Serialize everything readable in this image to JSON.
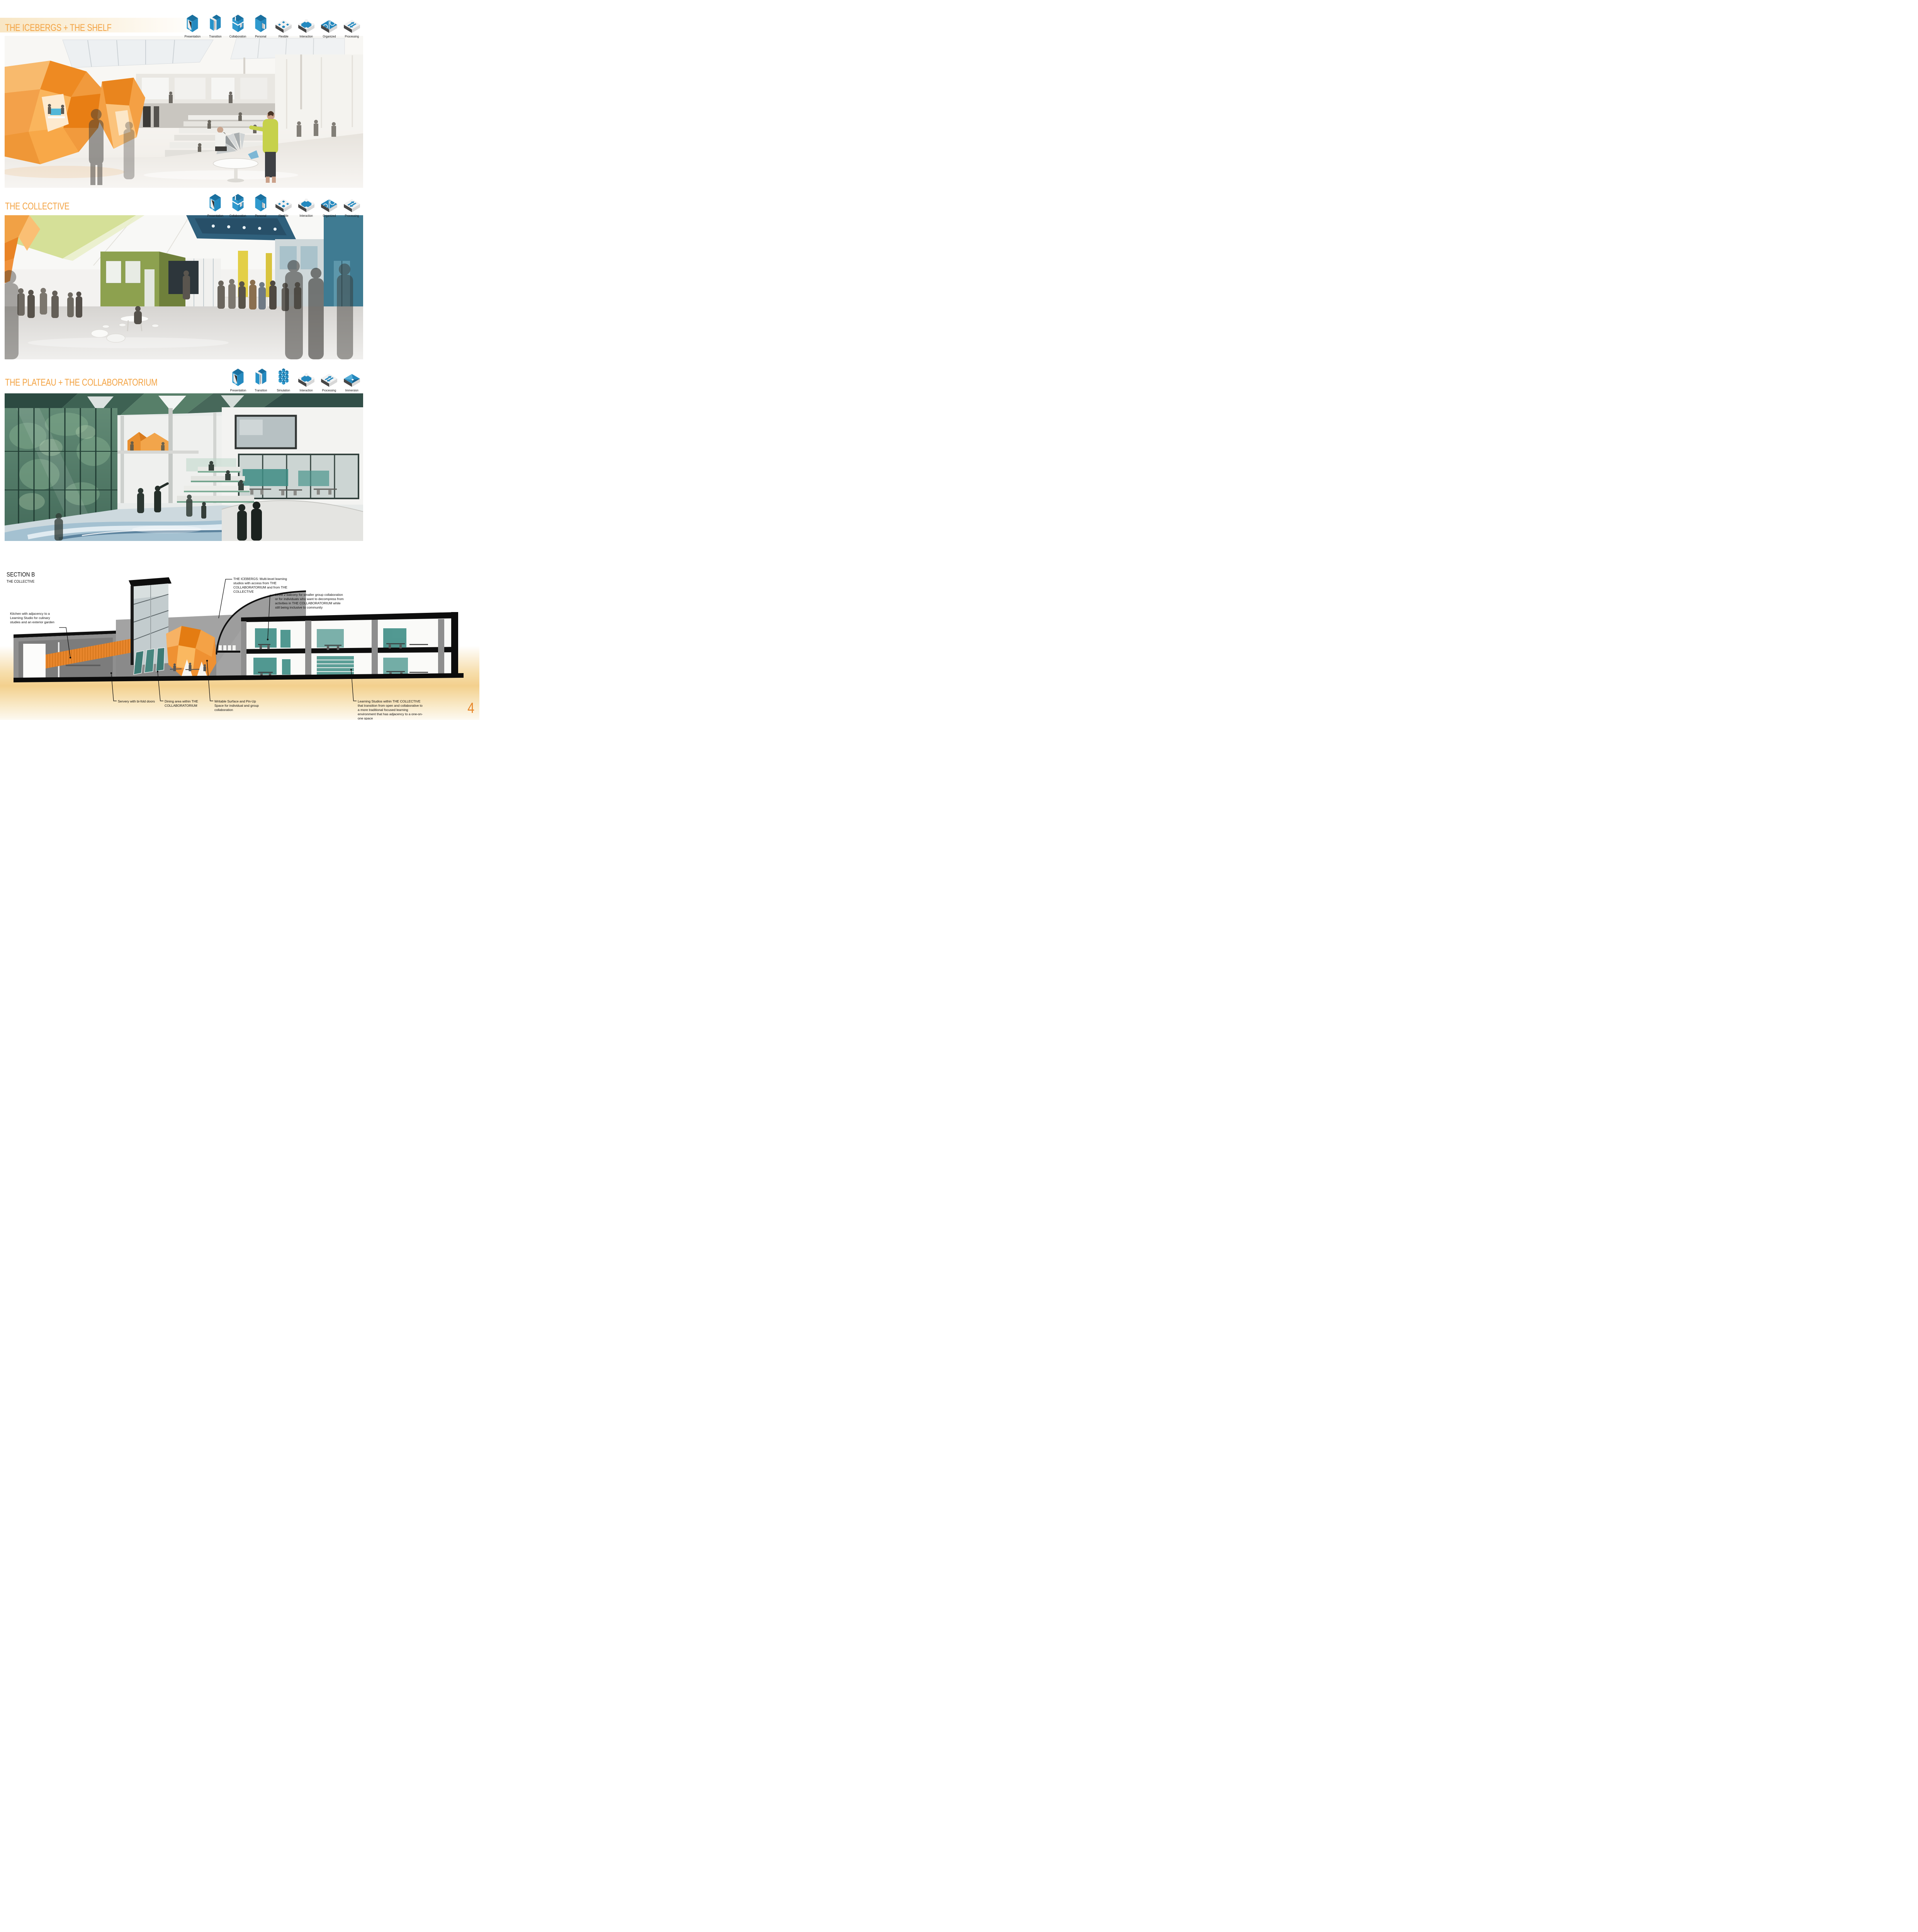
{
  "page": {
    "number": "4"
  },
  "palette": {
    "accent_orange": "#f3a343",
    "icon_blue": "#2489bf",
    "page_number_orange": "#e8872b"
  },
  "sections": [
    {
      "title": "THE ICEBERGS + THE SHELF",
      "icons": [
        "Presentation",
        "Transition",
        "Collaboration",
        "Personal",
        "Flexible",
        "Interaction",
        "Organized",
        "Processing"
      ]
    },
    {
      "title": "THE COLLECTIVE",
      "icons": [
        "Presentation",
        "Collaboration",
        "Personal",
        "Flexible",
        "Interaction",
        "Organized",
        "Processing"
      ]
    },
    {
      "title": "THE PLATEAU + THE COLLABORATORIUM",
      "icons": [
        "Presentation",
        "Transition",
        "Simulation",
        "Interaction",
        "Processing",
        "Immersion"
      ]
    }
  ],
  "section_figure": {
    "label": "SECTION B",
    "sublabel": "THE COLLECTIVE",
    "annotations": {
      "icebergs": "THE ICEBERGS: Multi-level learning studios with access from THE COLLABORATORIUM and from THE COLLECTIVE",
      "balcony": "Level 2 balcony for smaller group collaboration or for individuals who want to decompress from activities in THE COLLABORATORIUM while still being inclusive to community",
      "kitchen": "Kitchen with adjacency to a Learning Studio for culinary studies and an exterior garden",
      "servery": "Servery with bi-fold doors",
      "dining": "Dining area within THE COLLABORATORIUM",
      "writable": "Writable Surface and Pin-Up Space for individual and group collaboration",
      "learning_studios": "Learning Studios within THE COLLECTIVE that transition from open and collaborative to a more traditional focused learning environment that has adjacency to a one-on-one space"
    }
  }
}
